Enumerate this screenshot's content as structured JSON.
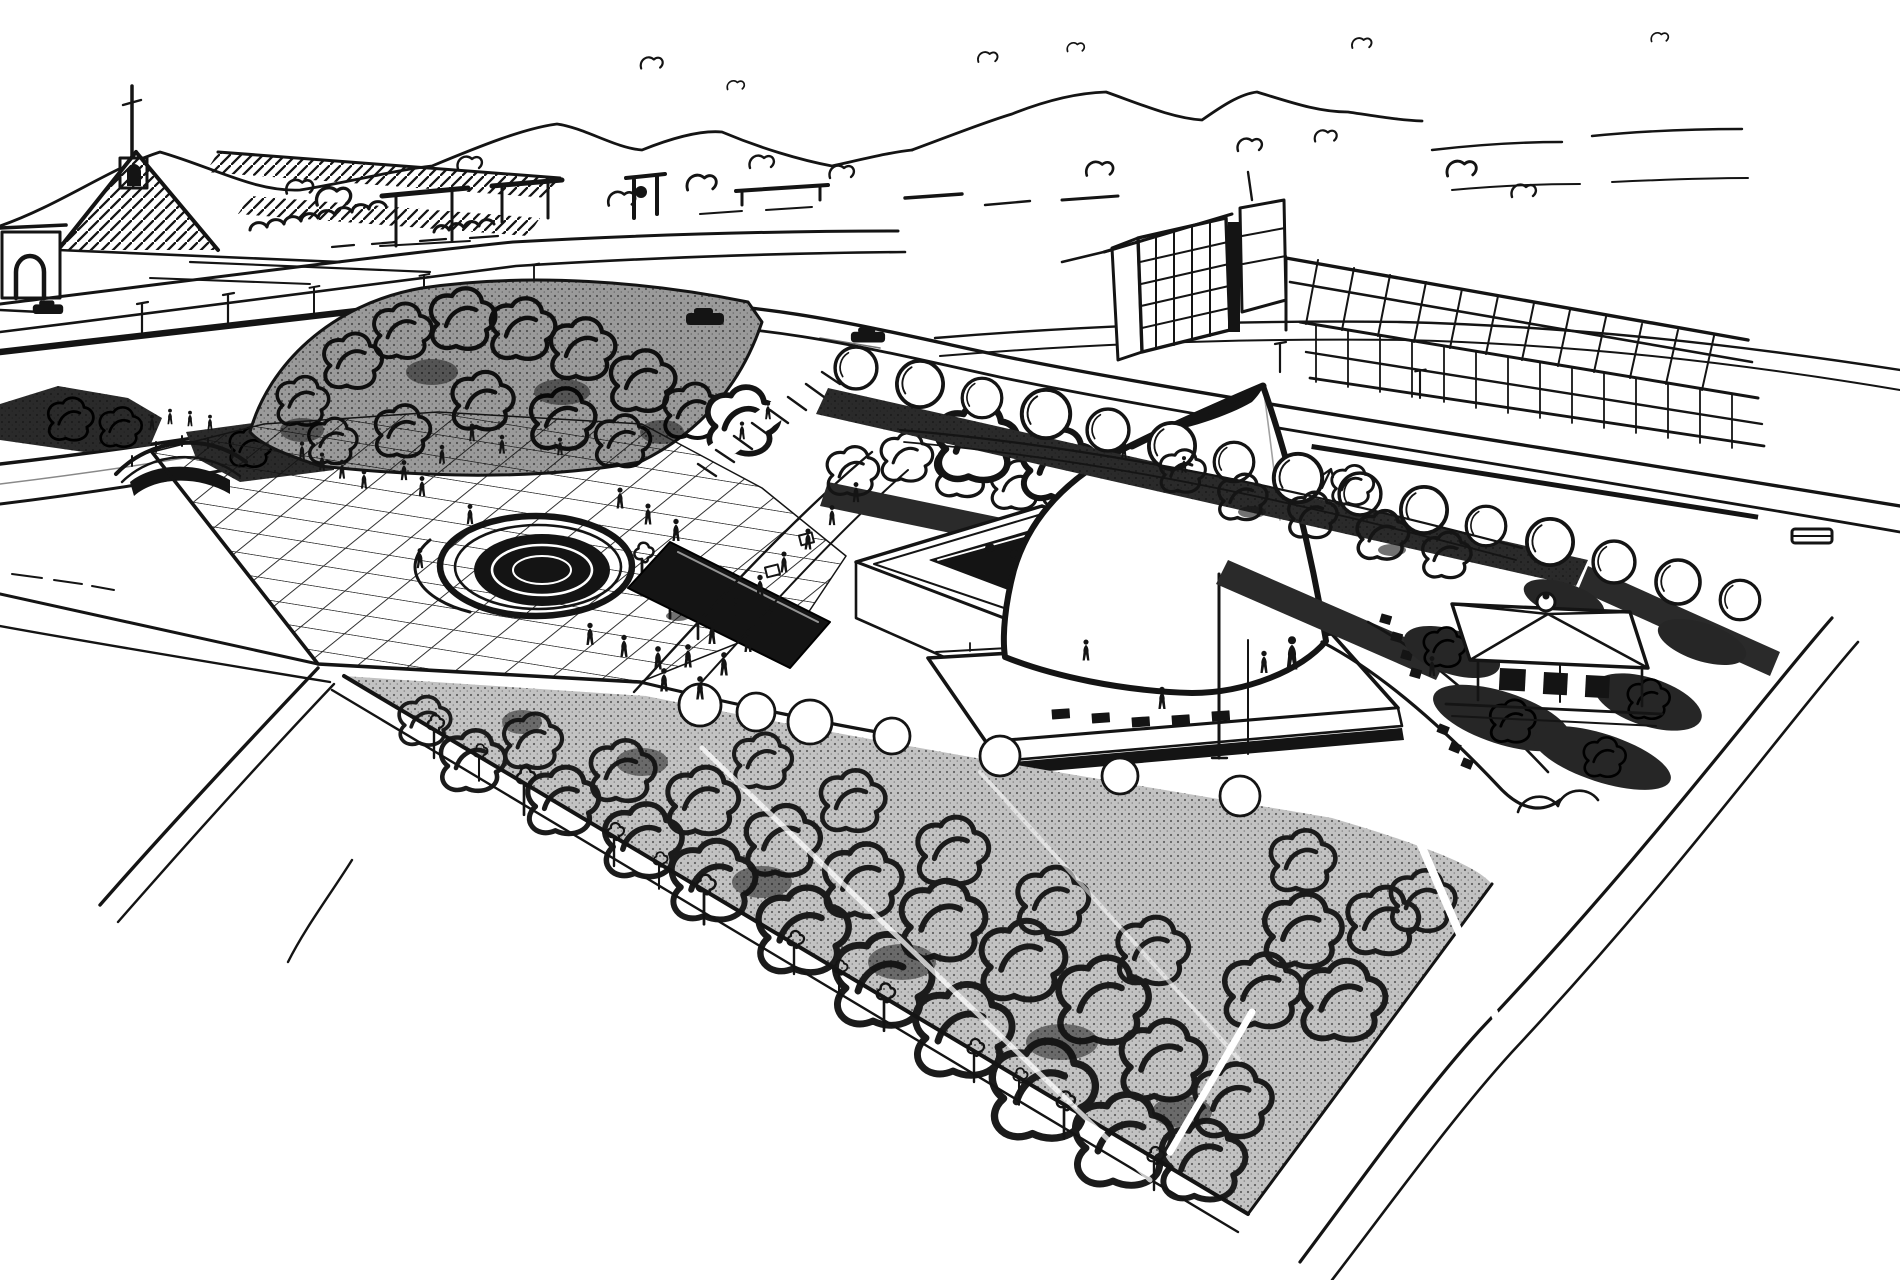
{
  "page": {
    "title": "Architectural concept sketch — aerial perspective",
    "description": "Hand-drawn black ink aerial perspective sketch of a cultural-centre site: a gridded plaza with a round fountain pool, a dark rectangular reflecting pool, a courtyard building, a large flaring pyramid hall on a podium, a small hip-roofed pavilion, rows of round trees, a dense shaded forest crossed by diagonal paths, perimeter roads with cars, a pedestrian bridge, and a distant town with a church spire, greenhouses, a gridded office block and hills on the horizon.",
    "medium": "ink on paper"
  },
  "palette": {
    "paper": "#ffffff",
    "ink": "#141414",
    "shade_dark": "#2a2a2a",
    "shade_mid": "#9a9a9a",
    "forest_base": "#c2c2c2"
  },
  "scene": {
    "parts": [
      {
        "id": "hills",
        "label": "Distant hills"
      },
      {
        "id": "sky-marks",
        "label": "Sky scribbles"
      },
      {
        "id": "church",
        "label": "Church with spire and hatched roofs"
      },
      {
        "id": "gate-arch",
        "label": "Arched gate building"
      },
      {
        "id": "town-center",
        "label": "Distant town structures"
      },
      {
        "id": "background-trees",
        "label": "Background tree curls"
      },
      {
        "id": "boulevard",
        "label": "Boulevard behind the site"
      },
      {
        "id": "tower-building",
        "label": "Gridded office block"
      },
      {
        "id": "greenhouse-sheds",
        "label": "Long glazed sheds"
      },
      {
        "id": "ne-road",
        "label": "North-east perimeter road"
      },
      {
        "id": "cars",
        "label": "Cars on the roads"
      },
      {
        "id": "tree-row-ne",
        "label": "Row of round trees along the road"
      },
      {
        "id": "sunken-road",
        "label": "Sunken road"
      },
      {
        "id": "bridge",
        "label": "Pedestrian bridge"
      },
      {
        "id": "hedge-left",
        "label": "Hedge masses at the west entry"
      },
      {
        "id": "tree-berm",
        "label": "Dense tree berm above the plaza"
      },
      {
        "id": "berm-steps",
        "label": "Stepped path through the berm"
      },
      {
        "id": "plaza",
        "label": "Gridded plaza"
      },
      {
        "id": "fountain-pond",
        "label": "Round fountain pool"
      },
      {
        "id": "reflecting-pool",
        "label": "Dark reflecting pool"
      },
      {
        "id": "walk-to-hall",
        "label": "Pedestrian walk to the hall"
      },
      {
        "id": "courtyard-building",
        "label": "Courtyard building"
      },
      {
        "id": "podium",
        "label": "Podium terrace"
      },
      {
        "id": "pyramid-hall",
        "label": "Flaring pyramid hall"
      },
      {
        "id": "flagpole",
        "label": "Flagpoles"
      },
      {
        "id": "lawn-trees",
        "label": "Scattered lawn trees"
      },
      {
        "id": "ne-hedges",
        "label": "Hedge strips"
      },
      {
        "id": "east-walkway",
        "label": "Curved east walkway"
      },
      {
        "id": "pavilion",
        "label": "Hip-roofed pavilion"
      },
      {
        "id": "pavilion-hedges",
        "label": "Hedges around the pavilion"
      },
      {
        "id": "se-road",
        "label": "South-east perimeter road"
      },
      {
        "id": "forest",
        "label": "Dense forest"
      },
      {
        "id": "forest-paths",
        "label": "Diagonal forest paths"
      },
      {
        "id": "sw-paths",
        "label": "Paths to the south-west"
      },
      {
        "id": "people",
        "label": "Small figures of people"
      }
    ]
  }
}
